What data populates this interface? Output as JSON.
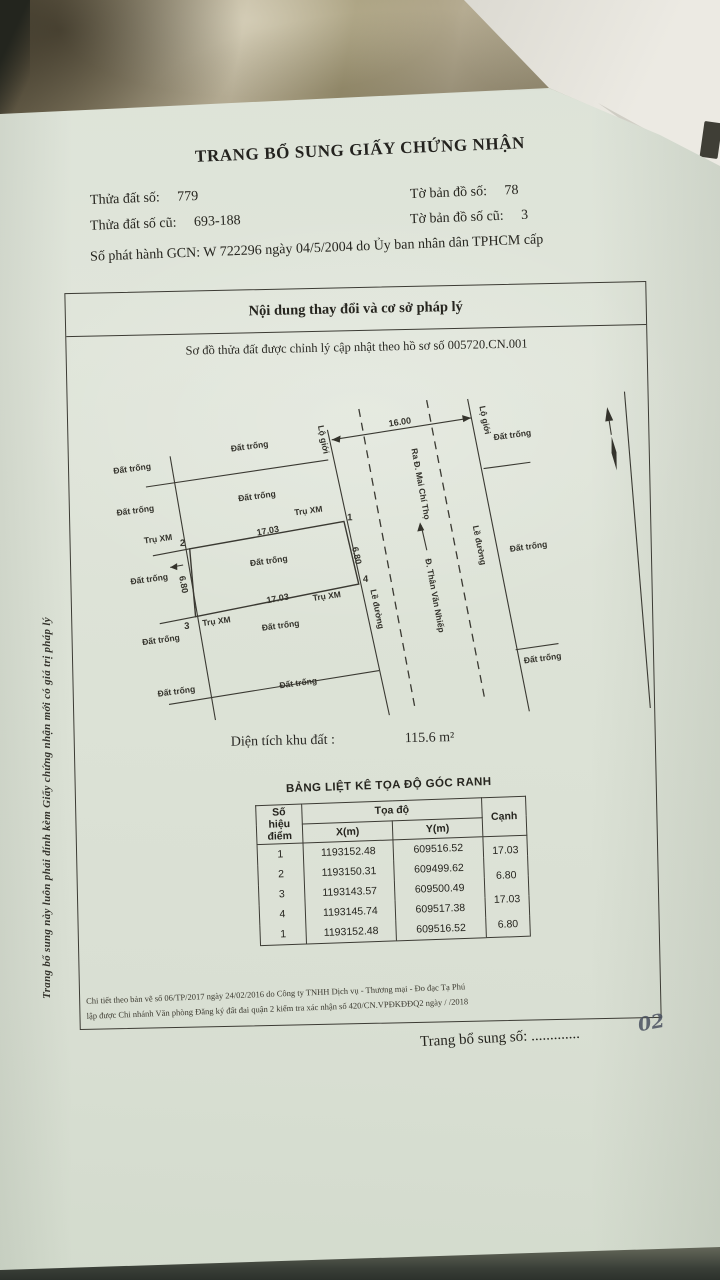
{
  "document": {
    "title": "TRANG BỔ SUNG GIẤY CHỨNG NHẬN",
    "info": {
      "parcel_label": "Thửa đất số:",
      "parcel_value": "779",
      "parcel_old_label": "Thửa đất số cũ:",
      "parcel_old_value": "693-188",
      "map_sheet_label": "Tờ bản đồ số:",
      "map_sheet_value": "78",
      "map_sheet_old_label": "Tờ bản đồ số cũ:",
      "map_sheet_old_value": "3",
      "issue_line": "Số phát hành GCN:  W 722296 ngày  04/5/2004 do Ủy ban nhân dân TPHCM cấp"
    },
    "box": {
      "header": "Nội dung thay đổi và cơ sở pháp lý",
      "subtitle": "Sơ đồ thửa đất được chỉnh lý cập nhật theo hồ sơ số 005720.CN.001",
      "area_label": "Diện tích khu đất :",
      "area_value": "115.6 m²",
      "table_title": "BẢNG LIỆT KÊ TỌA ĐỘ GÓC RANH",
      "footer_line1": "Chi tiết theo bản vẽ số 06/TP/2017 ngày 24/02/2016 do Công ty TNHH Dịch vụ - Thương mại - Đo đạc Tạ Phú",
      "footer_line2": "lập được Chi nhánh Văn phòng Đăng ký đất đai quận 2 kiểm tra xác nhận số 420/CN.VPĐKĐĐQ2 ngày    /    /2018"
    },
    "diagram": {
      "vacant": "Đất trống",
      "road_boundary": "Lộ giới",
      "road_edge": "Lề đường",
      "road_to": "Ra Đ. Mai Chí Thọ",
      "road_name": "Đ. Thân Văn Nhiếp",
      "post": "Trụ XM",
      "dim_top": "16.00",
      "dim_long": "17.03",
      "dim_short": "6.80",
      "pt1": "1",
      "pt2": "2",
      "pt3": "3",
      "pt4": "4"
    },
    "table": {
      "col_point_l1": "Số hiệu",
      "col_point_l2": "điểm",
      "col_coords": "Tọa độ",
      "col_x": "X(m)",
      "col_y": "Y(m)",
      "col_edge": "Cạnh",
      "rows": [
        {
          "point": "1",
          "x": "1193152.48",
          "y": "609516.52"
        },
        {
          "point": "2",
          "x": "1193150.31",
          "y": "609499.62"
        },
        {
          "point": "3",
          "x": "1193143.57",
          "y": "609500.49"
        },
        {
          "point": "4",
          "x": "1193145.74",
          "y": "609517.38"
        },
        {
          "point": "1",
          "x": "1193152.48",
          "y": "609516.52"
        }
      ],
      "edges": [
        "17.03",
        "6.80",
        "17.03",
        "6.80"
      ]
    },
    "supplement_label": "Trang bổ sung số: .............",
    "handwritten_number": "02",
    "side_note": "Trang bổ sung này luôn phải đính kèm Giấy chứng nhận mới có giá trị pháp lý"
  },
  "colors": {
    "paper": "#dce1d6",
    "ink": "#2b2a26",
    "fabric": "#a89c82",
    "sheet": "#eceae4",
    "hand": "#4a5160"
  }
}
